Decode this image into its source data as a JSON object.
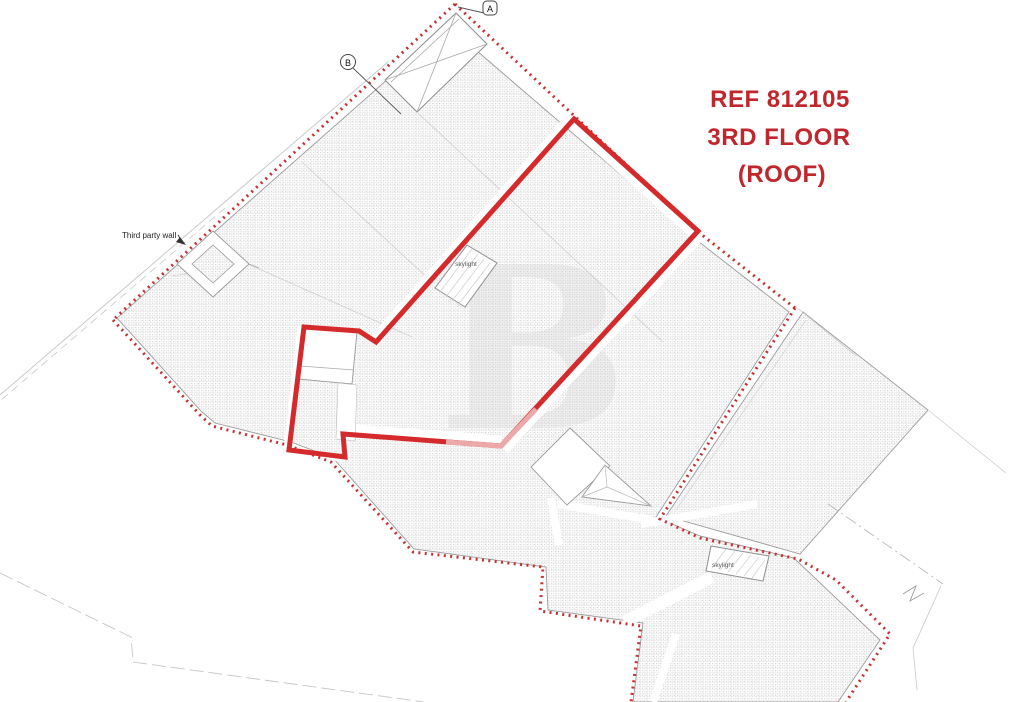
{
  "title_block": {
    "ref": "REF 812105",
    "floor": "3RD FLOOR",
    "roof": "(ROOF)",
    "color": "#c0272d"
  },
  "section_markers": {
    "a": "A",
    "b": "B"
  },
  "annotations": {
    "third_party_wall": "Third party wall",
    "skylight_upper": "skylight",
    "skylight_lower": "skylight"
  },
  "watermark": {
    "letter": "B"
  },
  "legend_colors": {
    "demise_outline_red": "#d42a2c",
    "demise_faded_red": "#eba9a9",
    "boundary_dotted_red": "#c63031",
    "roof_hatch_grey": "#c9c9c9",
    "structure_outline_grey": "#9a9a9a"
  }
}
